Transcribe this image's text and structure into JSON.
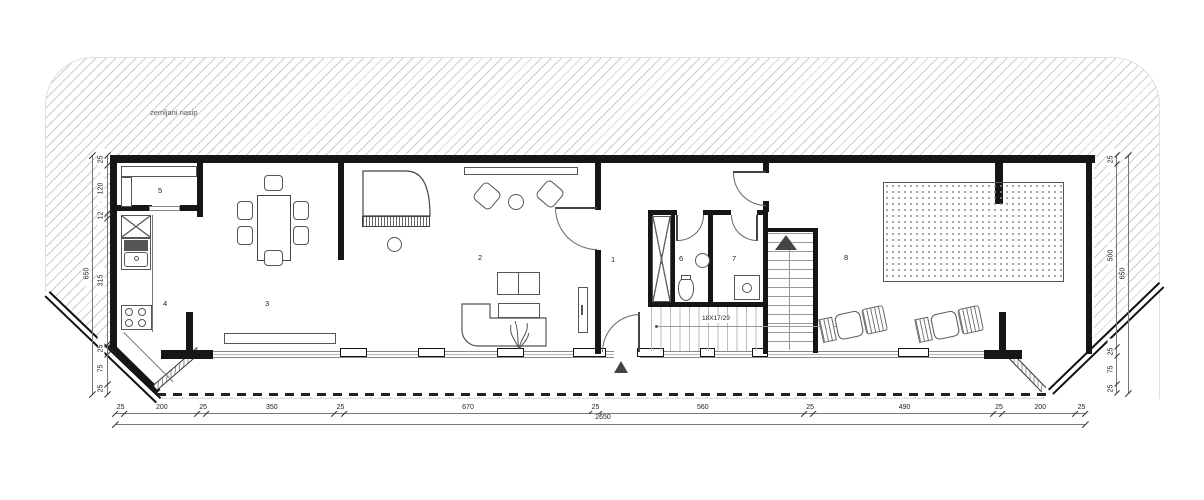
{
  "drawing": {
    "berm_label": "zemljani nasip",
    "stair_label": "18X17/29"
  },
  "rooms": [
    "1",
    "2",
    "3",
    "4",
    "5",
    "6",
    "7",
    "8"
  ],
  "dimensions": {
    "bottom": {
      "segments": [
        "25",
        "200",
        "25",
        "350",
        "25",
        "670",
        "25",
        "560",
        "25",
        "490",
        "25",
        "200",
        "25"
      ],
      "total": "2650"
    },
    "left": {
      "segments": [
        "25",
        "120",
        "12",
        "315",
        "25",
        "75",
        "25"
      ],
      "total": "650"
    },
    "right": {
      "segments": [
        "25",
        "500",
        "25",
        "75",
        "25"
      ],
      "total": "650"
    }
  }
}
